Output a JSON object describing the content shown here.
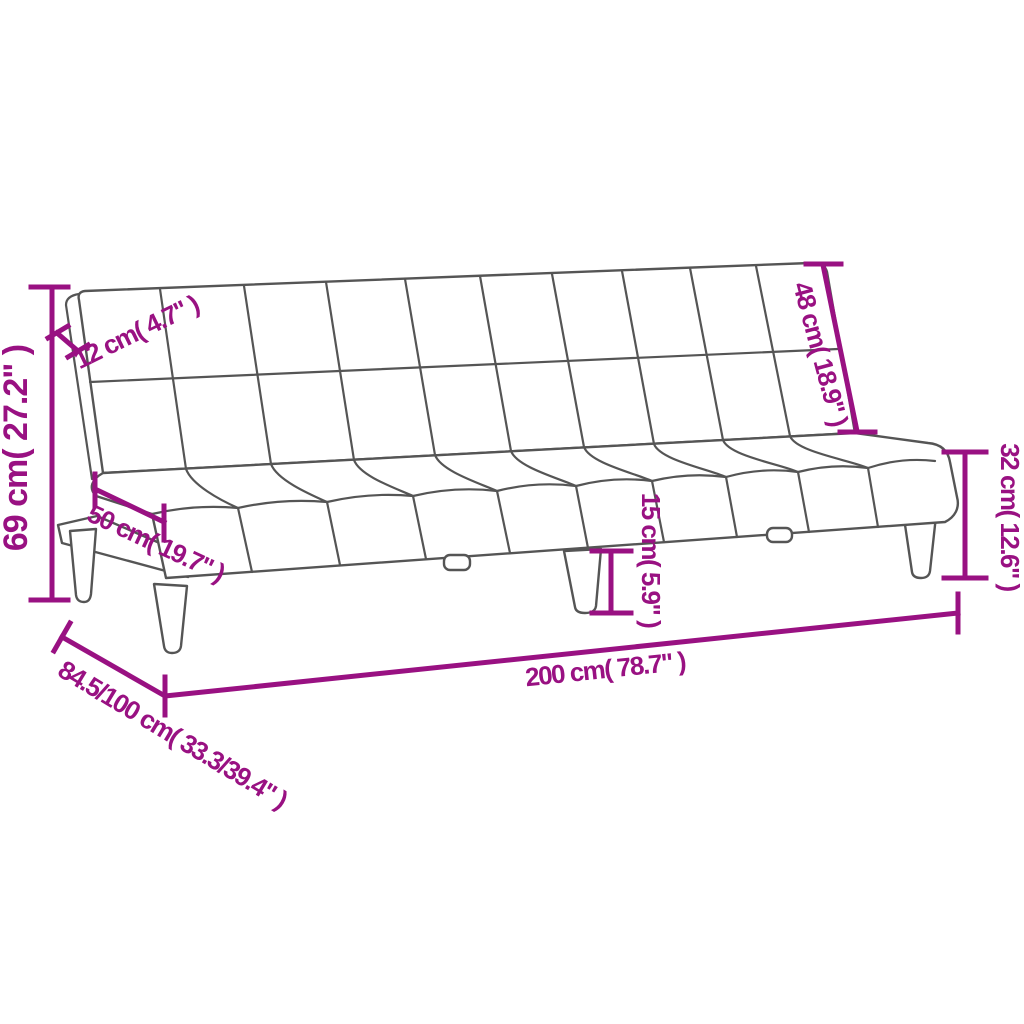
{
  "page": {
    "background_color": "#ffffff"
  },
  "diagram": {
    "kind": "product-dimension-diagram",
    "subject": "sofa-bed",
    "accent_color": "#991182",
    "outline_color": "#555555",
    "dimensions": {
      "overall_height": {
        "label": "69 cm( 27.2\" )"
      },
      "backrest_thickness": {
        "label": "12 cm( 4.7\" )"
      },
      "seat_depth": {
        "label": "50 cm( 19.7\" )"
      },
      "backrest_height": {
        "label": "48 cm( 18.9\" )"
      },
      "seat_height": {
        "label": "32 cm( 12.6\" )"
      },
      "leg_height": {
        "label": "15 cm( 5.9\" )"
      },
      "overall_width": {
        "label": "200 cm( 78.7\" )"
      },
      "depth_folded_unfolded": {
        "label": "84.5/100 cm( 33.3/39.4\" )"
      }
    }
  }
}
